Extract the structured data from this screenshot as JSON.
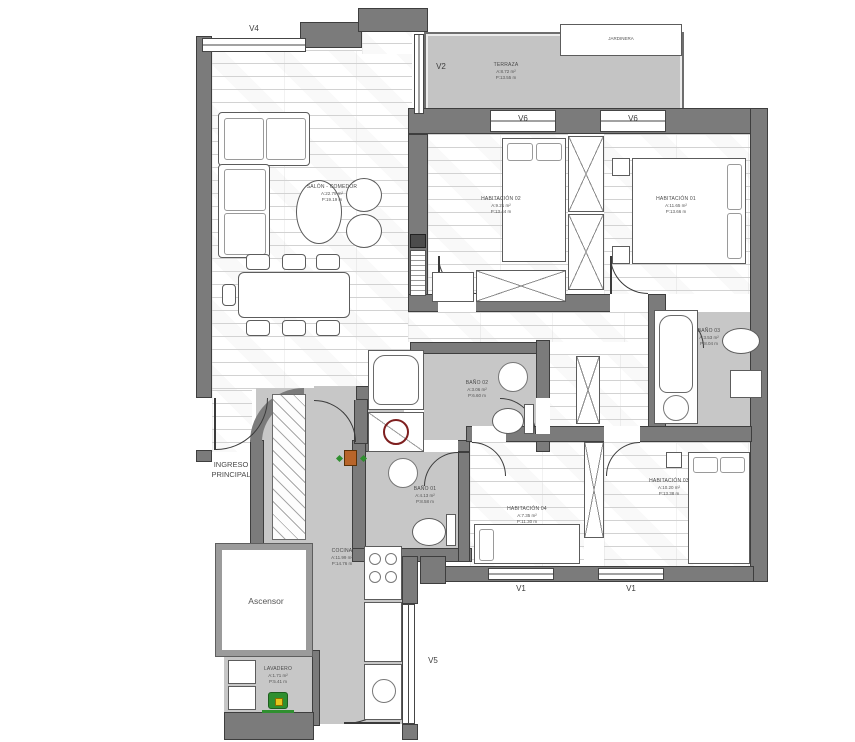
{
  "plan_title": "Apartment floor plan",
  "windows": {
    "v4": "V4",
    "v2": "V2",
    "v6a": "V6",
    "v6b": "V6",
    "v1a": "V1",
    "v1b": "V1",
    "v5": "V5"
  },
  "rooms": {
    "terraza": {
      "name": "TERRAZA",
      "area": "A:8.72 m²",
      "perimeter": "P:13.55 m"
    },
    "jardinera": {
      "name": "JARDINERA"
    },
    "salon": {
      "name": "SALÓN - COMEDOR",
      "area": "A:22.79 m²",
      "perimeter": "P:19.19 m"
    },
    "hab02": {
      "name": "HABITACIÓN 02",
      "area": "A:9.21 m²",
      "perimeter": "P:13.44 m"
    },
    "hab01": {
      "name": "HABITACIÓN 01",
      "area": "A:11.65 m²",
      "perimeter": "P:13.66 m"
    },
    "bano03": {
      "name": "BAÑO 03",
      "area": "A:3.53 m²",
      "perimeter": "P:8.04 m"
    },
    "bano02": {
      "name": "BAÑO 02",
      "area": "A:3.06 m²",
      "perimeter": "P:6.60 m"
    },
    "bano01": {
      "name": "BAÑO 01",
      "area": "A:4.13 m²",
      "perimeter": "P:8.58 m"
    },
    "hab04": {
      "name": "HABITACIÓN 04",
      "area": "A:7.35 m²",
      "perimeter": "P:11.30 m"
    },
    "hab03": {
      "name": "HABITACIÓN 03",
      "area": "A:10.20 m²",
      "perimeter": "P:13.38 m"
    },
    "cocina": {
      "name": "COCINA",
      "area": "A:11.99 m²",
      "perimeter": "P:14.76 m"
    },
    "lavadero": {
      "name": "LAVADERO",
      "area": "A:1.71 m²",
      "perimeter": "P:5.41 m"
    },
    "ascensor": {
      "name": "Ascensor"
    },
    "ingreso": {
      "line1": "INGRESO",
      "line2": "PRINCIPAL"
    }
  },
  "icons": {
    "washer_icon": "washing-machine",
    "shower_icon": "shower-tray-symbol",
    "thermostat_icon": "wall-unit"
  },
  "colors": {
    "wall": "#7b7b7b",
    "floor_gray": "#c7c7c7",
    "wood_line": "#d2d2d2",
    "accent_red": "#7e1f1f",
    "accent_green": "#2f8f2f",
    "accent_yellow": "#e7c61c",
    "accent_orange": "#b8652a"
  }
}
